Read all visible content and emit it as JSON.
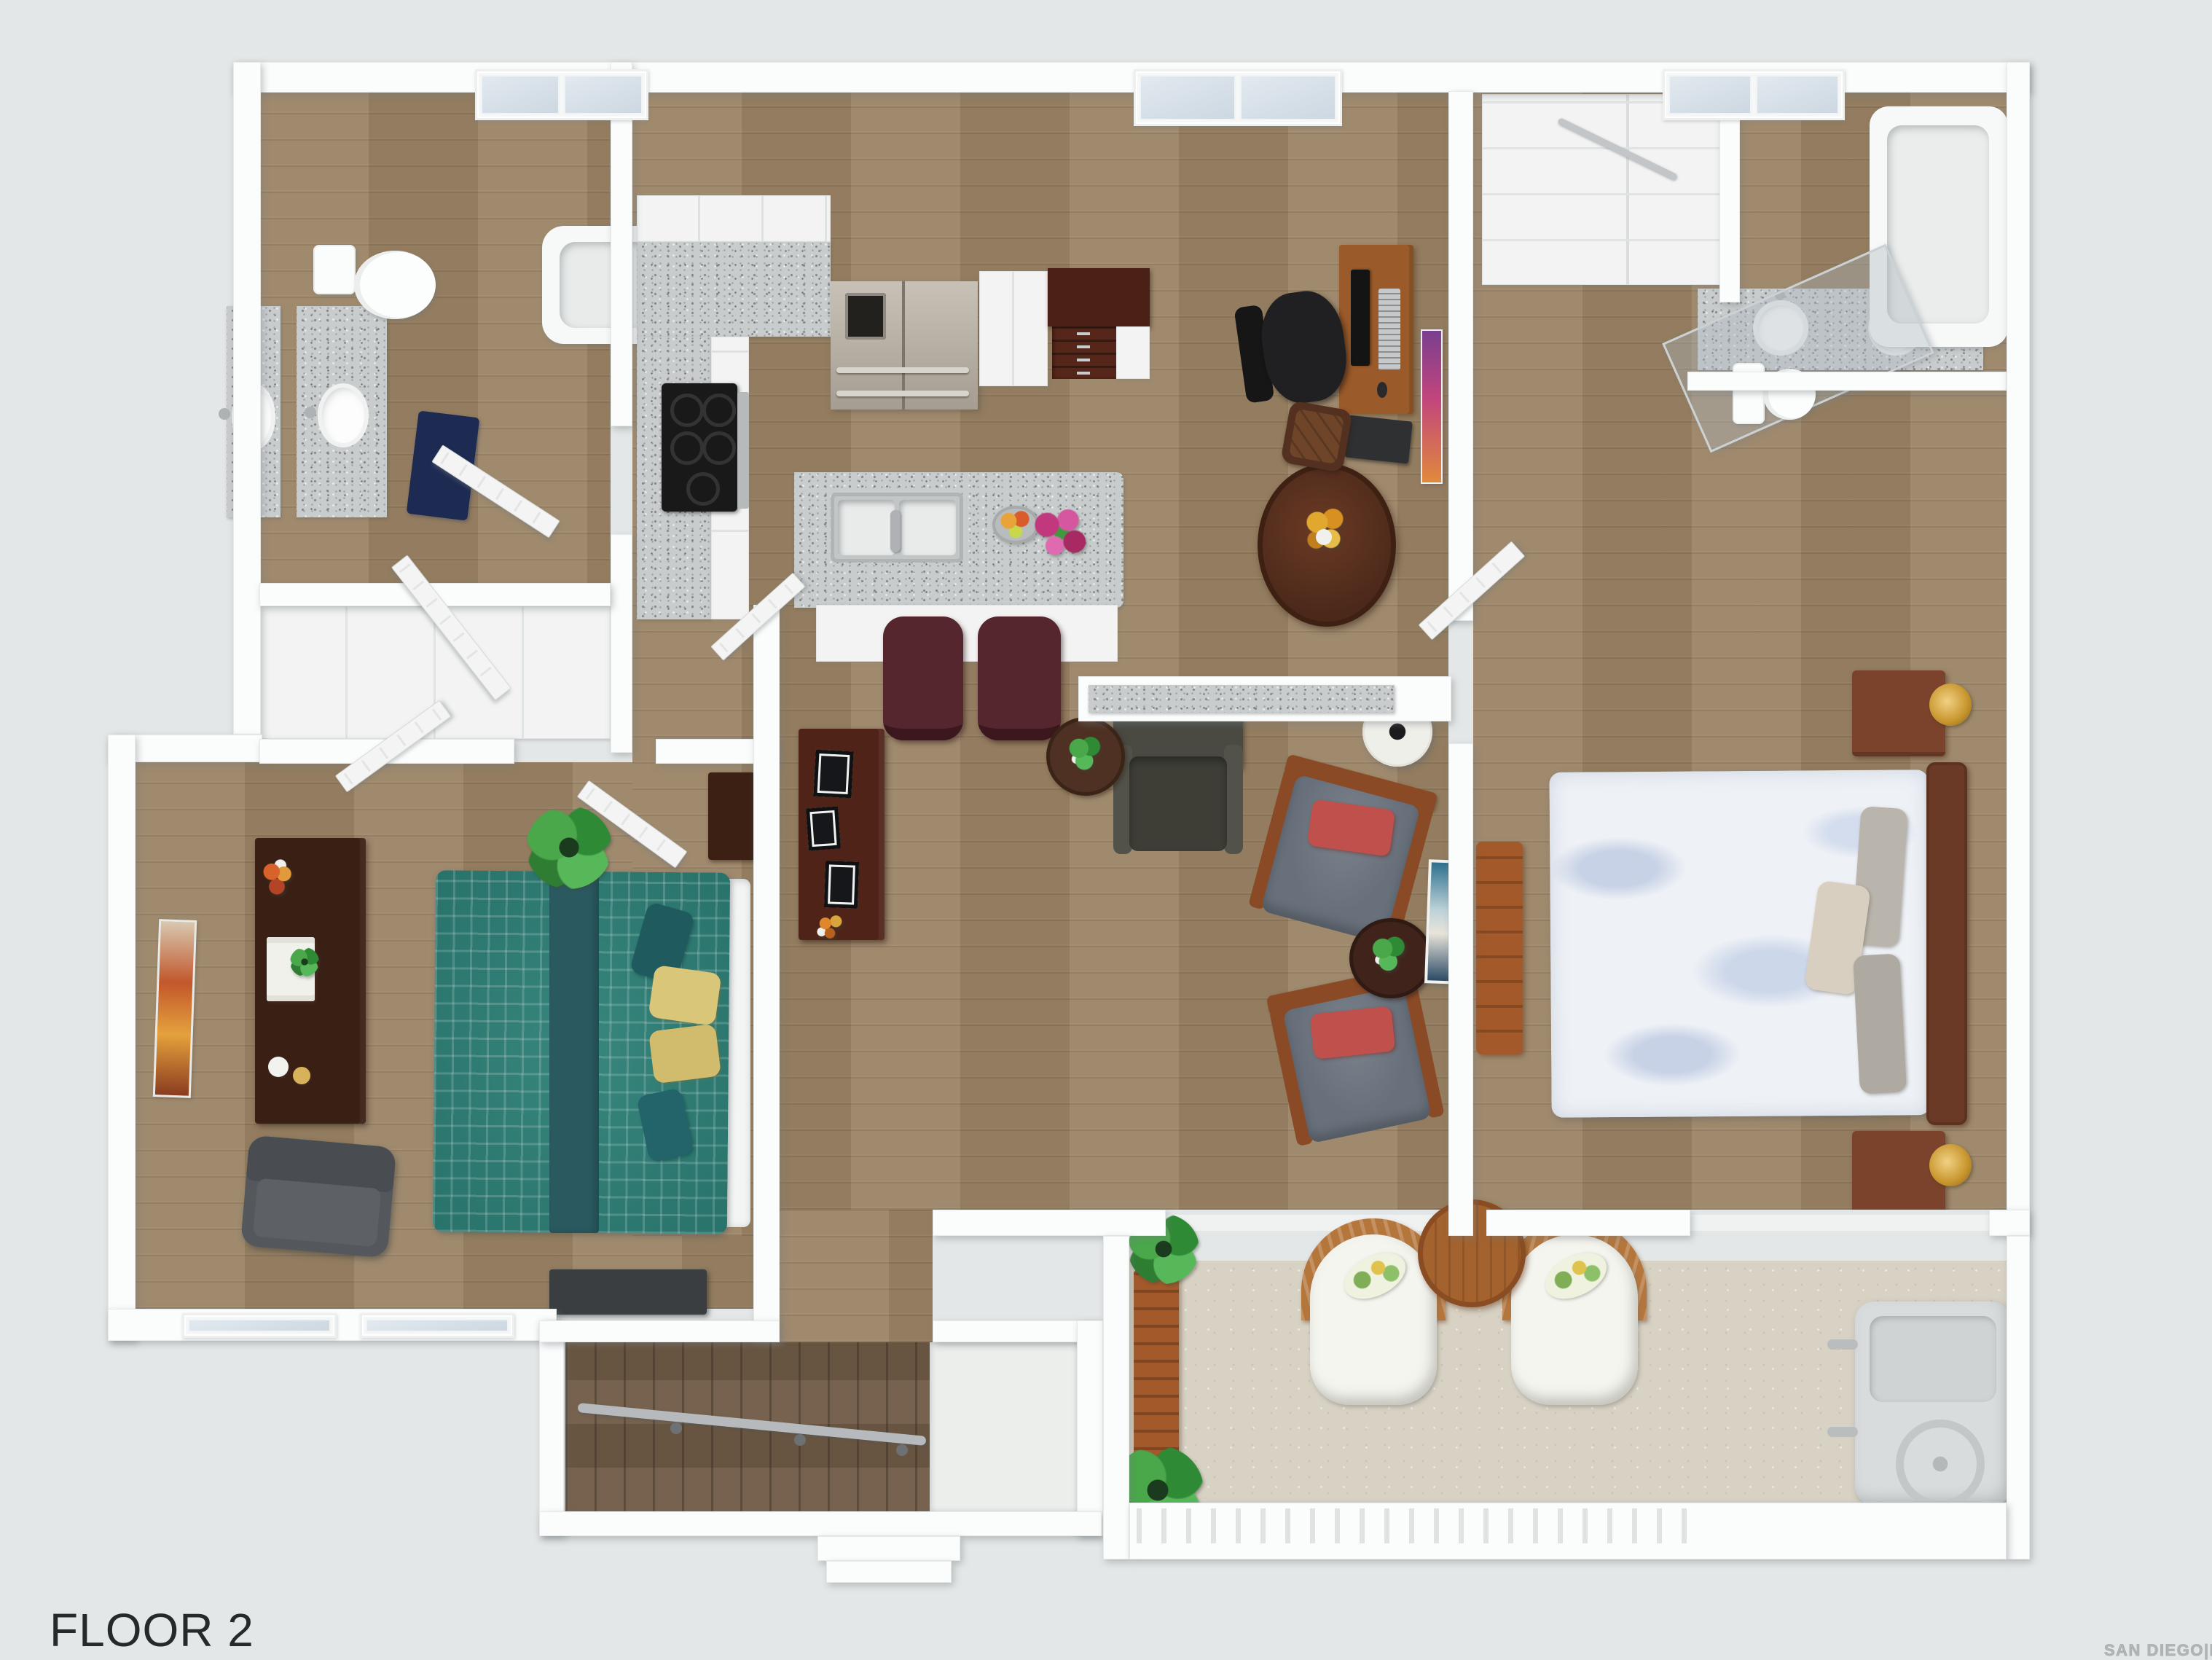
{
  "title": {
    "label": "FLOOR 2"
  },
  "watermark": {
    "label": "SAN DIEGO|MLS"
  },
  "palette": {
    "bg": "#e4e7e7",
    "wall": "#fbfcfc",
    "wood": "#9a8365",
    "wood-dark": "#6f5a45",
    "granite": "#c9cccd",
    "white-cab": "#f2f3f2",
    "balcony": "#d8d2c4",
    "teal": "#2c7f76",
    "teal-dark": "#2a5a60",
    "yellow-pillow": "#d9c678",
    "espresso": "#3a1f15",
    "cherry": "#6b3a26",
    "wood-furn": "#7c432c",
    "gold": "#c9972f",
    "gray-chair": "#68707b",
    "red-pillow": "#c0504b",
    "recliner": "#45453d",
    "maroon": "#55262e",
    "desk-wood": "#9a5a2a",
    "wicker": "#b5763c",
    "ac": "#d9dcdd",
    "stainless": "#b1a99d",
    "plantc": "#3f9a3f",
    "navy": "#1d2a52",
    "title-color": "#26292c",
    "watermark-color": "#a9adad"
  }
}
